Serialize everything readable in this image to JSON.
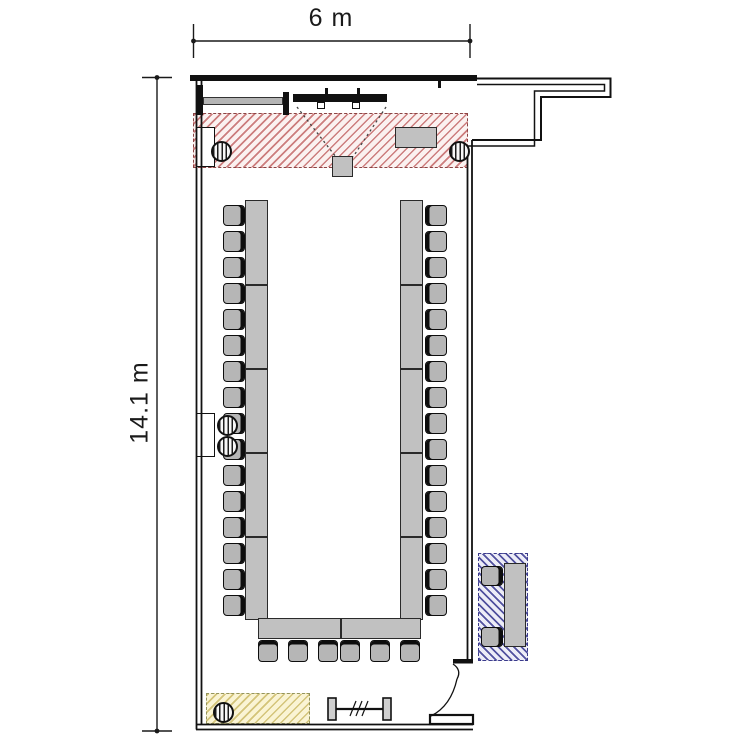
{
  "plan": {
    "type": "meeting-room-floor-plan",
    "background": "#ffffff",
    "wall_color": "#111111"
  },
  "dimensions": {
    "top_label": "6 m",
    "left_label": "14.1 m"
  },
  "zones": {
    "stage": {
      "name": "stage-hatch-zone",
      "hatch_color": "#c67070",
      "border_color": "#8a4444",
      "style": "diagonal-hatch"
    },
    "storage": {
      "name": "yellow-hatch-zone",
      "hatch_color": "#cdbc69",
      "border_color": "#93935c",
      "style": "diagonal-hatch"
    },
    "lounge": {
      "name": "blue-hatch-zone",
      "hatch_color": "#414196",
      "border_color": "#3a3a8a",
      "style": "diagonal-hatch"
    }
  },
  "furniture": {
    "left_row_chair_count": 16,
    "right_row_chair_count": 16,
    "bottom_row_chair_count": 6,
    "lounge_chair_count": 2,
    "pillar_count": 5,
    "table_fill": "#c1c1c1",
    "chair_fill": "#b6b6b6",
    "layout": "u-shape"
  }
}
